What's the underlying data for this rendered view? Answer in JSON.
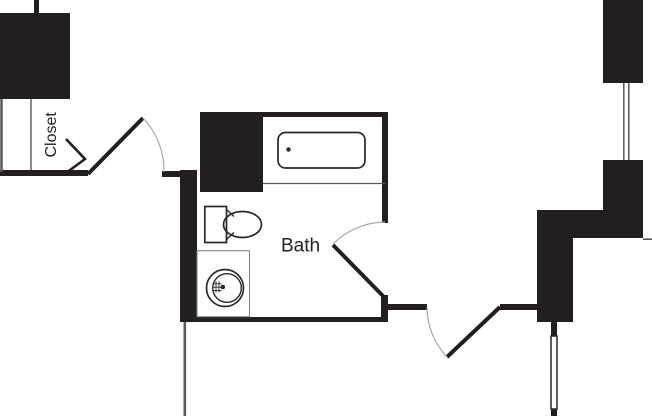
{
  "title": "floor-plan",
  "rooms": {
    "bath": {
      "label": "Bath"
    },
    "closet": {
      "label": "Closet"
    }
  },
  "fixtures": {
    "bathtub": "bathtub",
    "toilet": "toilet",
    "sink": "sink-vanity",
    "window": "window"
  },
  "colors": {
    "wall": "#231f20",
    "fixture": "#2b2727",
    "thin_line": "#58595b",
    "counter_line": "#808285",
    "door_arc": "#a7a9ac",
    "text": "#231f20",
    "background": "#ffffff"
  }
}
